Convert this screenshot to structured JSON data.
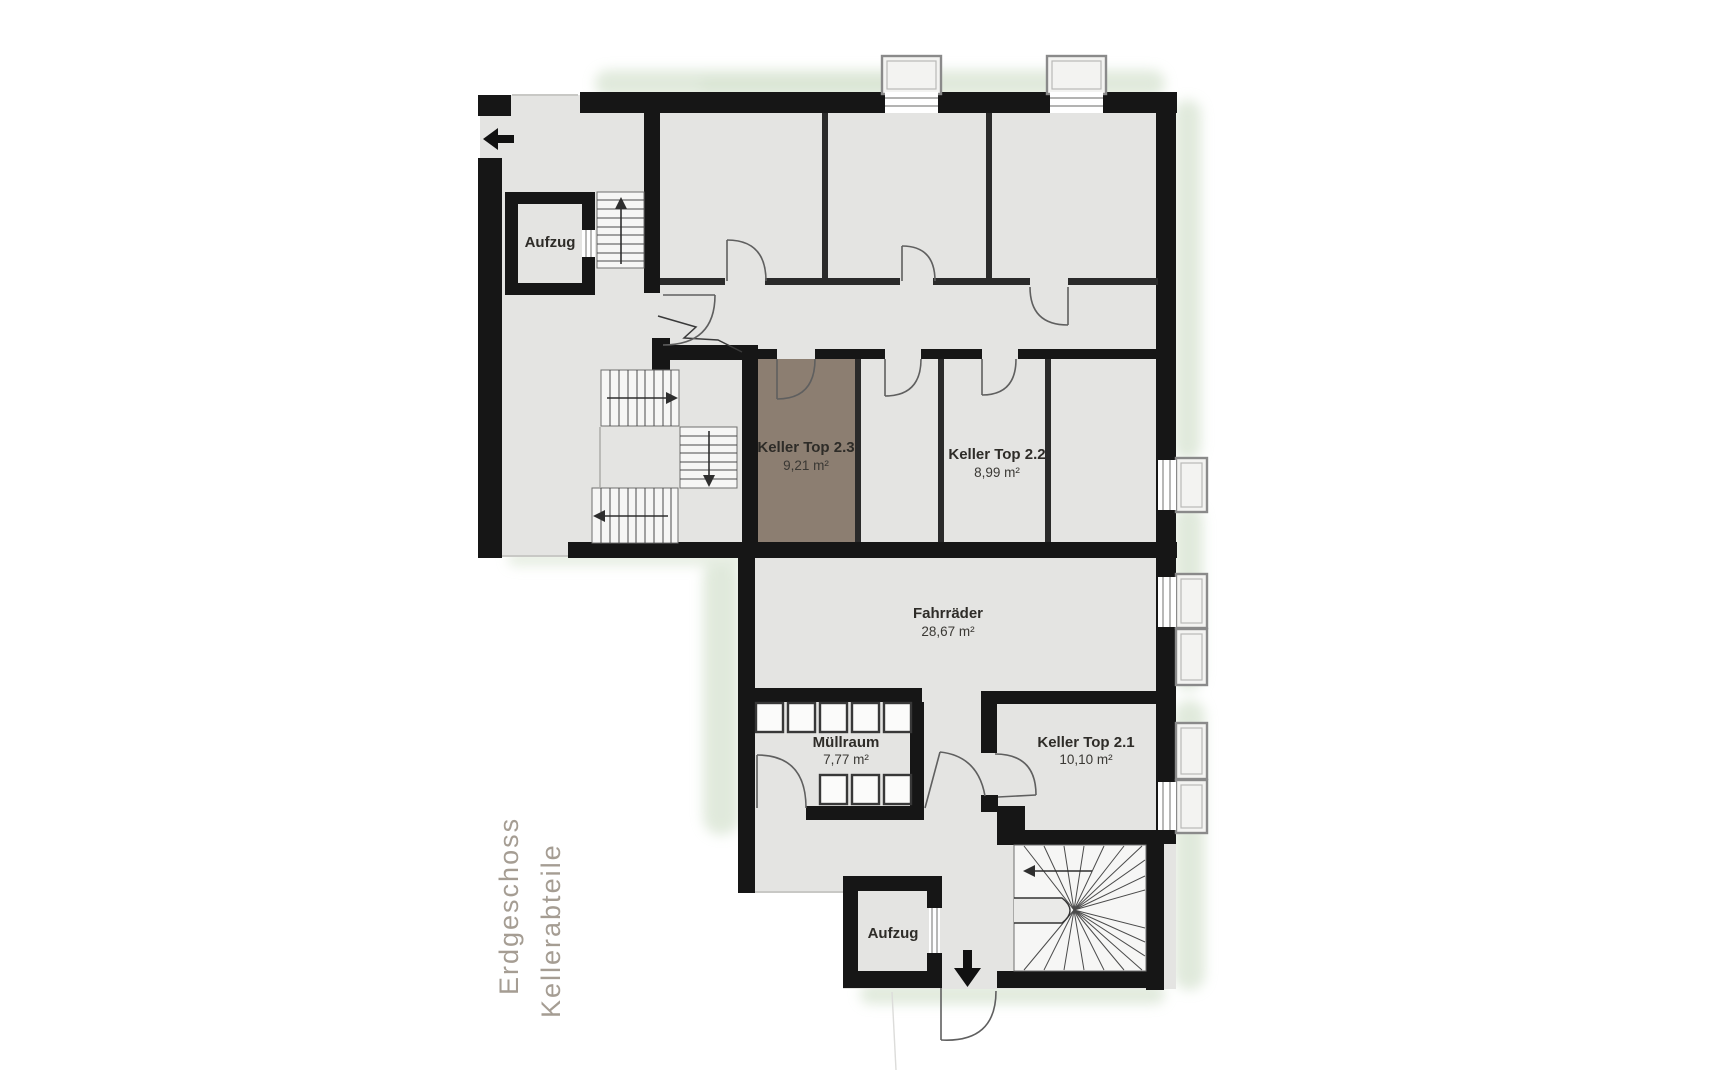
{
  "plan": {
    "rooms": [
      {
        "id": "aufzug_top",
        "label": "Aufzug",
        "area": ""
      },
      {
        "id": "keller_2_3",
        "label": "Keller Top 2.3",
        "area": "9,21 m²",
        "highlighted": true
      },
      {
        "id": "keller_2_2",
        "label": "Keller Top 2.2",
        "area": "8,99 m²"
      },
      {
        "id": "fahrraeder",
        "label": "Fahrräder",
        "area": "28,67 m²"
      },
      {
        "id": "muellraum",
        "label": "Müllraum",
        "area": "7,77 m²"
      },
      {
        "id": "keller_2_1",
        "label": "Keller Top 2.1",
        "area": "10,10 m²"
      },
      {
        "id": "aufzug_bottom",
        "label": "Aufzug",
        "area": ""
      }
    ],
    "captions": {
      "line1": "Erdgeschoss",
      "line2": "Kellerabteile"
    },
    "colors": {
      "wall": "#161616",
      "floor": "#e4e4e2",
      "highlight": "#8c7e71",
      "stair": "#f6f6f5",
      "greenery": "#ccdcc5",
      "caption": "#a59d93",
      "label_text": "#2e2c28"
    }
  }
}
